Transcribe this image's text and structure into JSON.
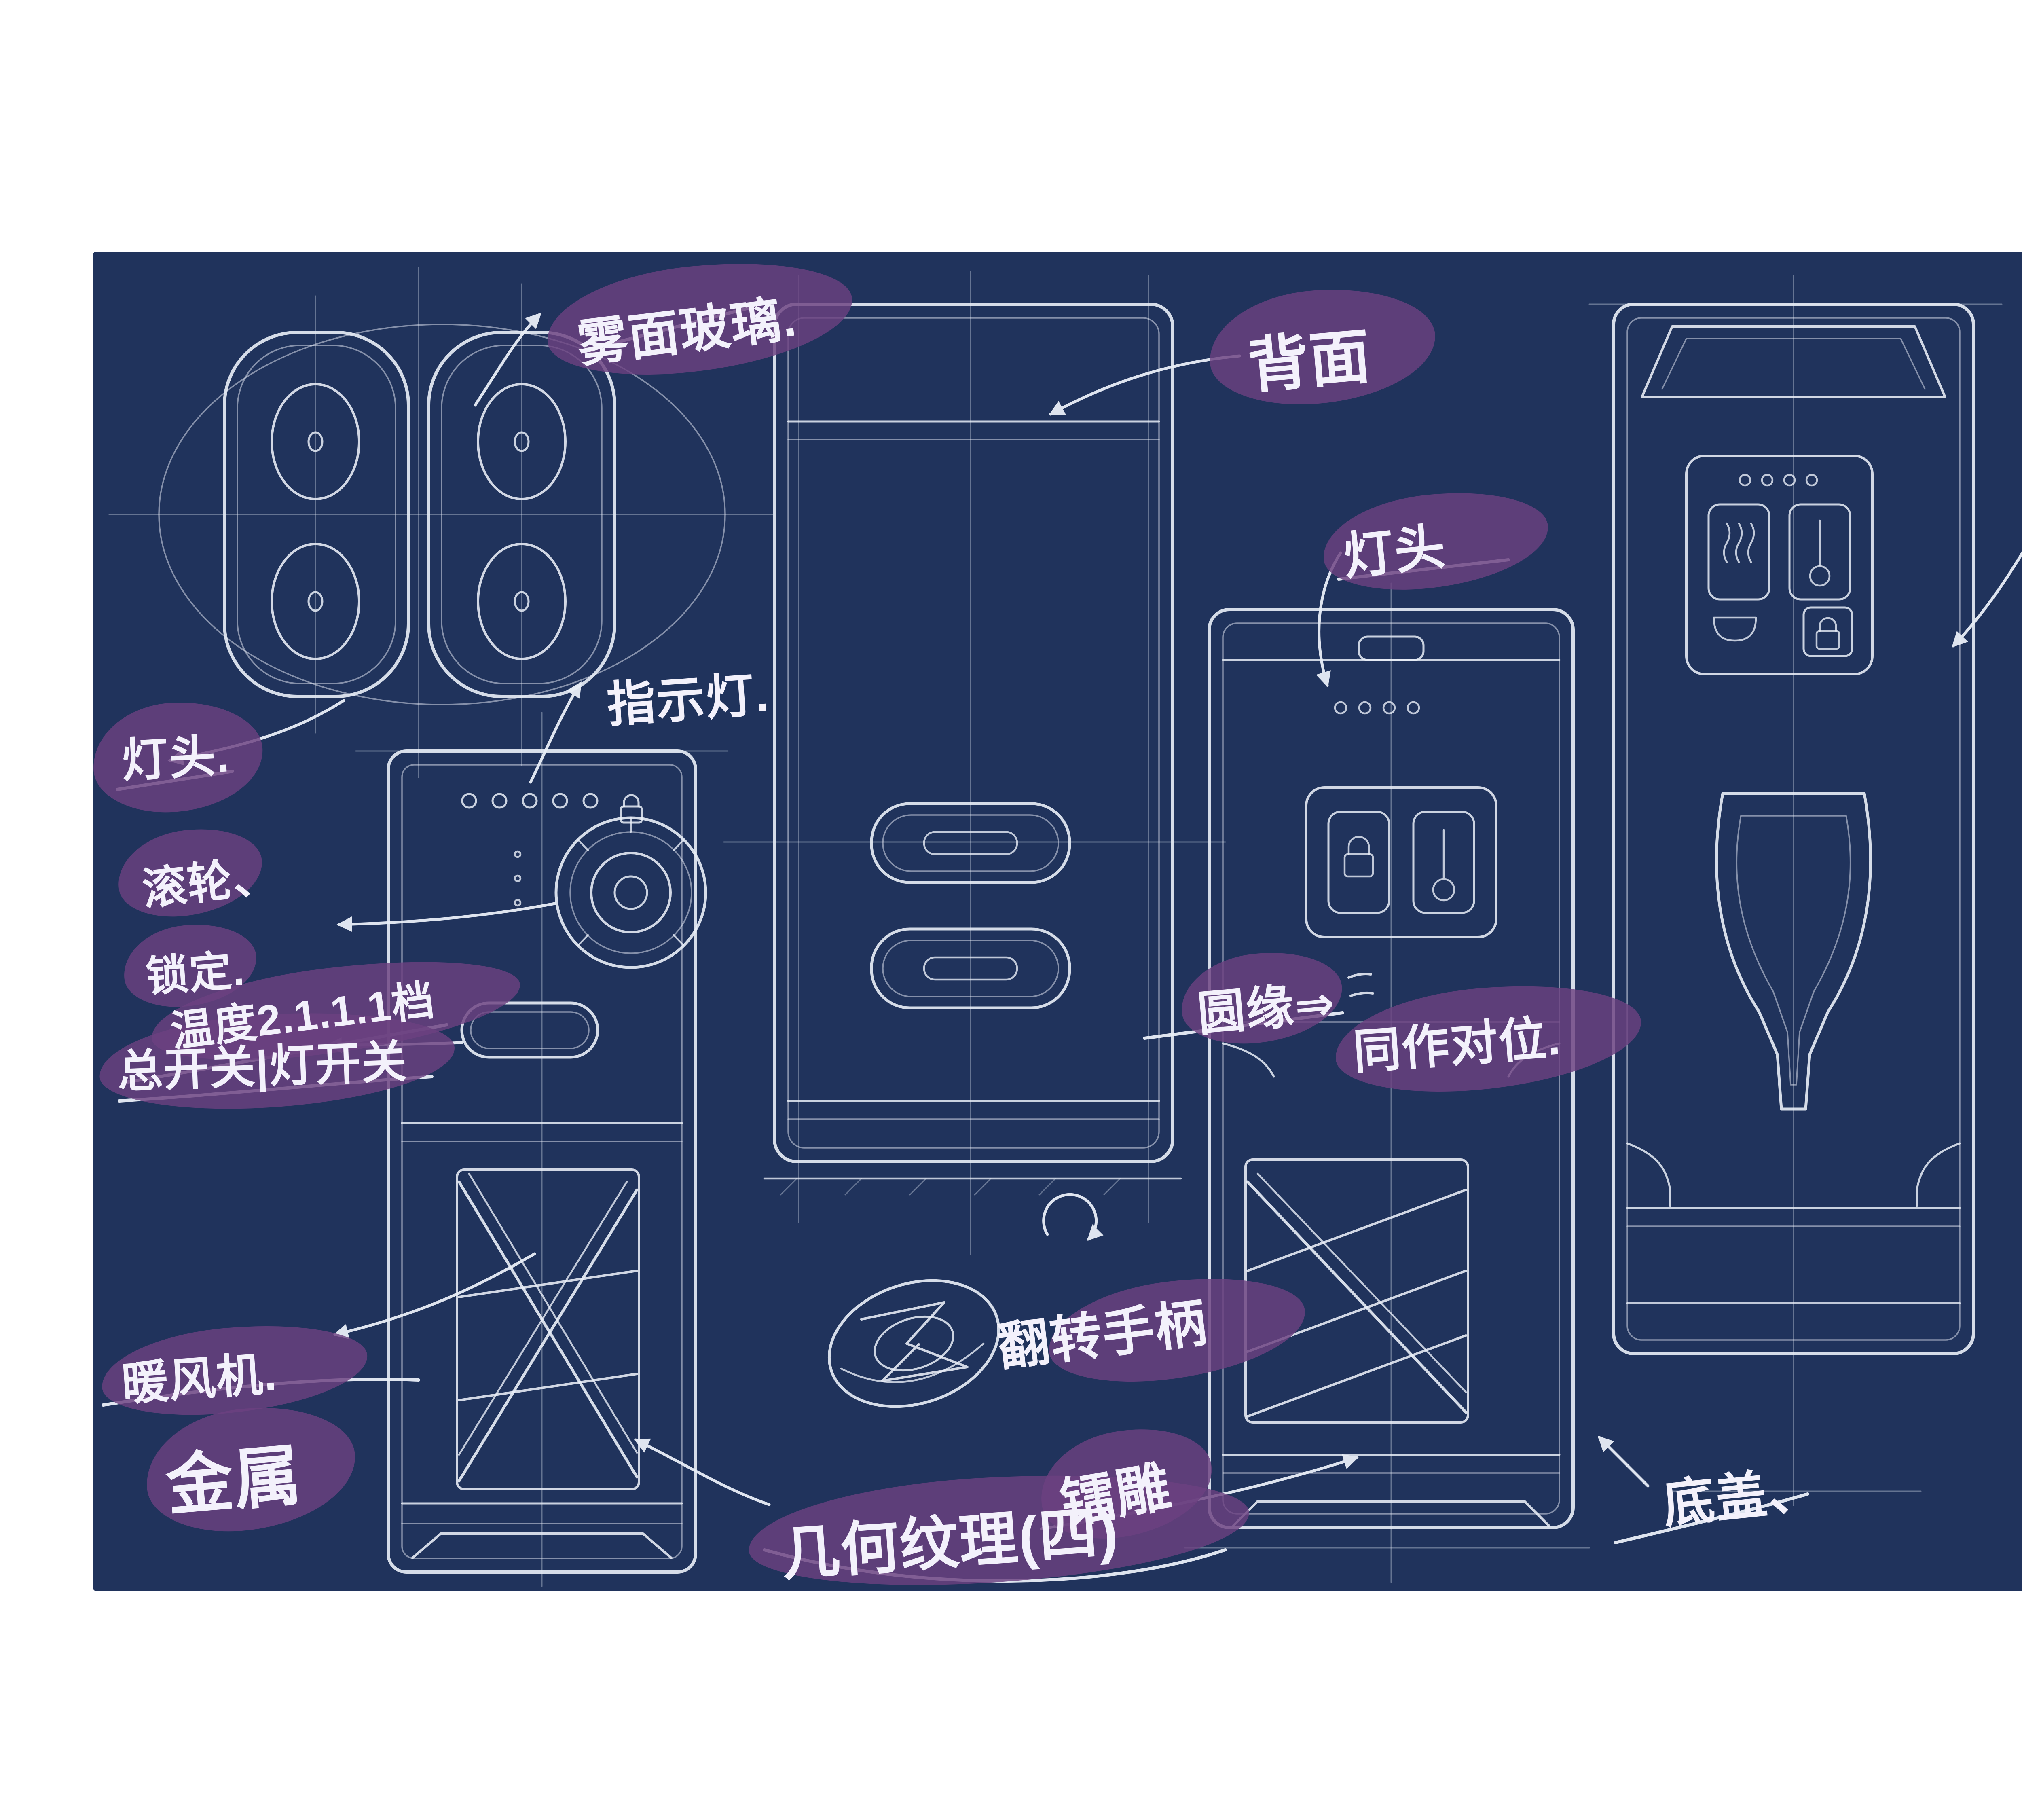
{
  "slide": {
    "background": "#ffffff"
  },
  "title": {
    "text": "草图设计",
    "chars": [
      "草",
      "图",
      "设",
      "计"
    ],
    "color": "#1c2f55"
  },
  "page_number": {
    "current": "41",
    "separator": "/",
    "total": "74"
  },
  "blueprint": {
    "background": "#20335c",
    "ink_color": "#e9eef7",
    "highlight_color": "#6b4180",
    "annotations": {
      "frosted_glass": "雾面玻璃.",
      "back_side": "背面",
      "lamp_head_mid": "灯头",
      "control_area": "操作区.",
      "indicator_light_right": "指示灯",
      "indicator_light_left": "指示灯.",
      "lamp_head_left": "灯头.",
      "roller": "滚轮、",
      "lock_setting": "锁定.",
      "temperature_levels": "温度2.1.1.1档",
      "main_light_switch": "总开关|灯开关",
      "warm_fan": "暖风机.",
      "metal": "金属",
      "geometric_texture": "几何纹理(四)",
      "laser_engraving": "镭雕",
      "flip_handle": "翻转手柄",
      "round_edge": "圆缘⇒",
      "sync_alignment": "同作对位.",
      "bottom_cover": "底盖、"
    }
  }
}
